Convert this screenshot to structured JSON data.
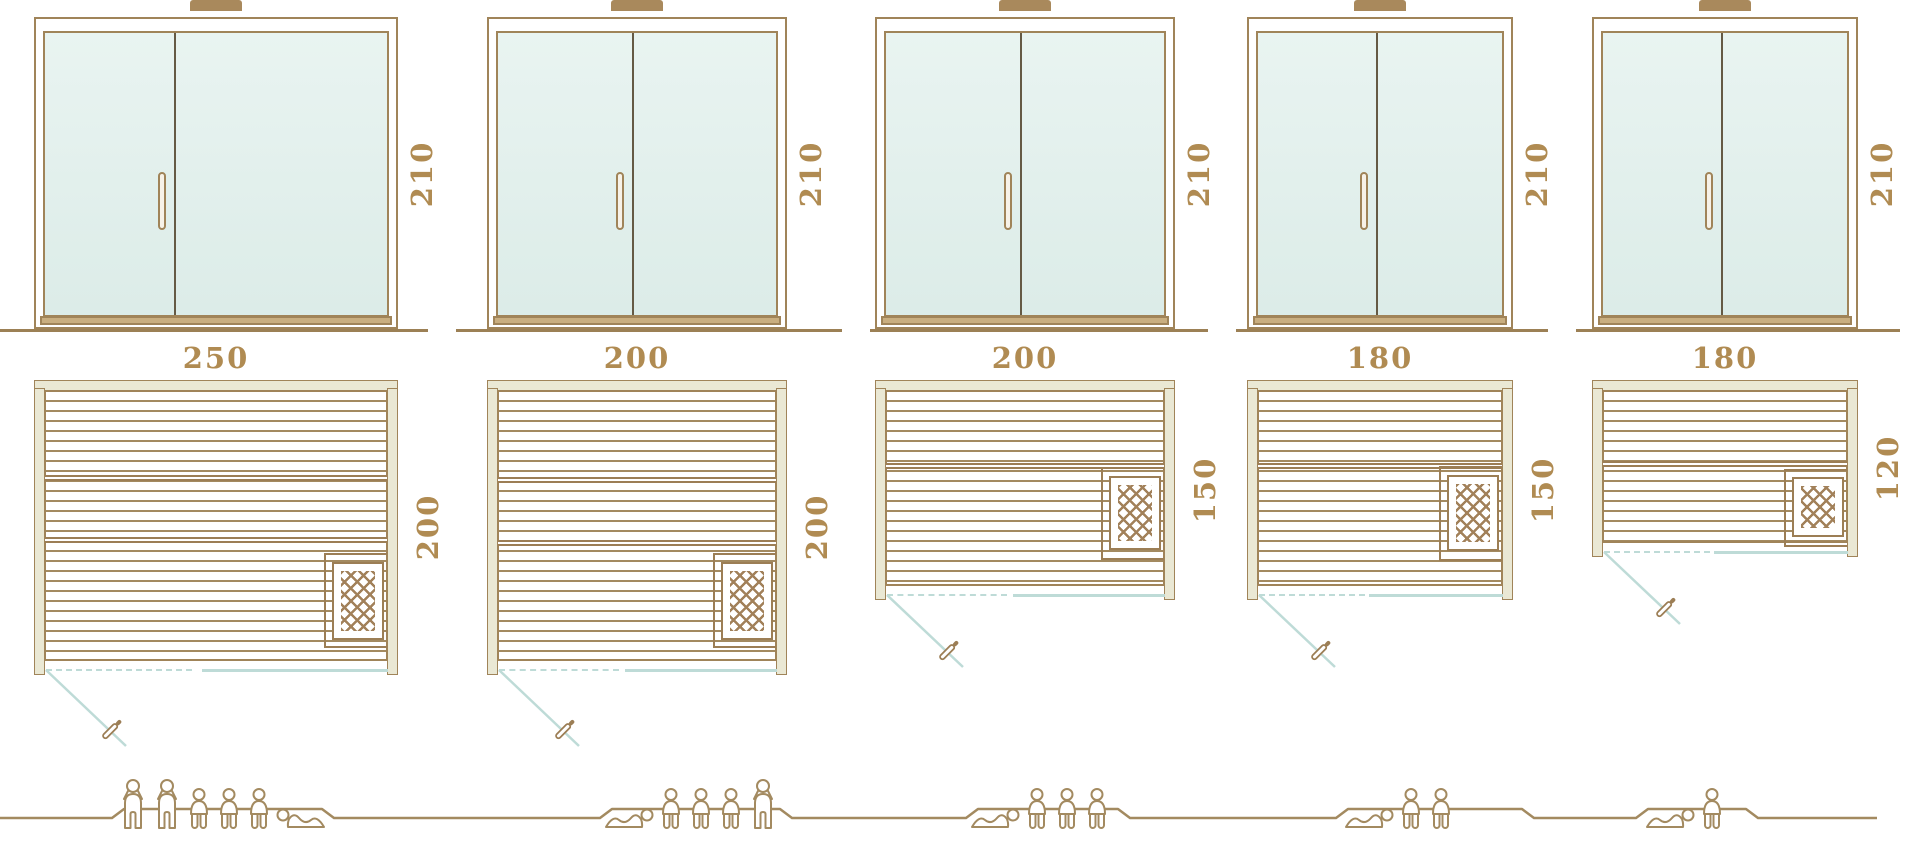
{
  "palette": {
    "line_brown": "#a08459",
    "label_brown": "#b08b52",
    "glass_mint": "#e2efeb",
    "wall_beige": "#eae8d4",
    "door_swing_teal": "#bedbd7"
  },
  "columns": [
    {
      "name": "sauna-variant-1",
      "door": {
        "height_label": "210"
      },
      "plan": {
        "width_label": "250",
        "depth_label": "200"
      },
      "people": [
        "standing",
        "standing",
        "seated",
        "seated",
        "seated",
        "lying-head-left"
      ],
      "capacity_total": 6
    },
    {
      "name": "sauna-variant-2",
      "door": {
        "height_label": "210"
      },
      "plan": {
        "width_label": "200",
        "depth_label": "200"
      },
      "people": [
        "lying-head-right",
        "seated",
        "seated",
        "seated",
        "standing"
      ],
      "capacity_total": 5
    },
    {
      "name": "sauna-variant-3",
      "door": {
        "height_label": "210"
      },
      "plan": {
        "width_label": "200",
        "depth_label": "150"
      },
      "people": [
        "lying-head-right",
        "seated",
        "seated",
        "seated"
      ],
      "capacity_total": 4
    },
    {
      "name": "sauna-variant-4",
      "door": {
        "height_label": "210"
      },
      "plan": {
        "width_label": "180",
        "depth_label": "150"
      },
      "people": [
        "lying-head-right",
        "seated",
        "seated"
      ],
      "capacity_total": 3
    },
    {
      "name": "sauna-variant-5",
      "door": {
        "height_label": "210"
      },
      "plan": {
        "width_label": "180",
        "depth_label": "120"
      },
      "people": [
        "lying-head-right",
        "seated"
      ],
      "capacity_total": 2
    }
  ]
}
